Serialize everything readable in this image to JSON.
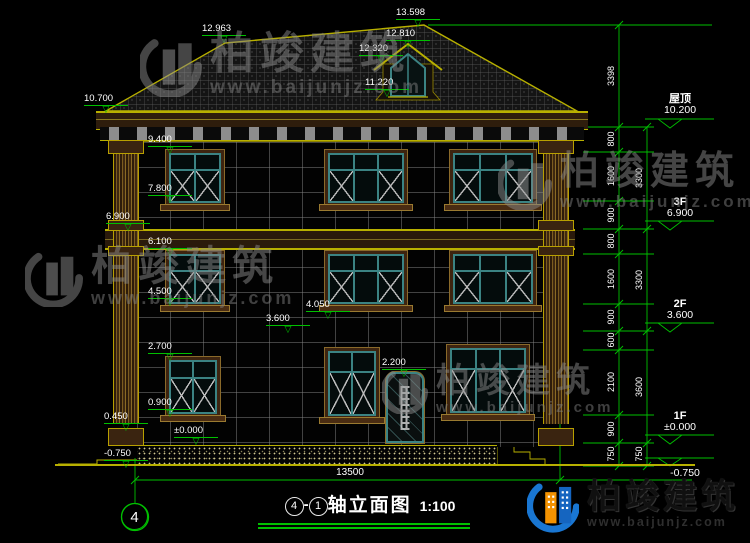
{
  "watermark": {
    "brand": "柏竣建筑",
    "url": "www.baijunjz.com"
  },
  "title_block": {
    "axis_from": "4",
    "separator": "-",
    "axis_to": "1",
    "name": "轴立面图",
    "scale": "1:100"
  },
  "axis_bubble": {
    "label": "4"
  },
  "levels": {
    "peak": "13.598",
    "left_ridge": "12.963",
    "dormer_ridge": "12.810",
    "dormer_eave": "12.320",
    "dormer_sill": "11.220",
    "main_eave": "10.700",
    "f3_window_top": "9.400",
    "f3_window_sill": "7.800",
    "f3_floor": "6.900",
    "f2_window_top": "6.100",
    "f2_window_sill": "4.500",
    "canopy_top": "4.050",
    "canopy_bottom": "3.600",
    "f1_left_window_top": "2.700",
    "door_top": "2.200",
    "f1_window_sill": "0.900",
    "ground_floor": "±0.000",
    "plinth_top": "0.450",
    "site_ground": "-0.750"
  },
  "right_markers": [
    {
      "label": "屋顶",
      "value": "10.200"
    },
    {
      "label": "3F",
      "value": "6.900"
    },
    {
      "label": "2F",
      "value": "3.600"
    },
    {
      "label": "1F",
      "value": "±0.000"
    },
    {
      "label": "",
      "value": "-0.750"
    }
  ],
  "dims": {
    "right_inner": [
      "3398",
      "800",
      "1600",
      "900",
      "800",
      "1600",
      "900",
      "600",
      "2100",
      "900",
      "750"
    ],
    "right_outer": [
      "3300",
      "3300",
      "3600",
      "750"
    ],
    "bottom_width": "13500"
  },
  "icons": {
    "level_marker": "▽"
  },
  "colors": {
    "background": "#000000",
    "dim_green": "#00c000",
    "line_yellow": "#b8b000",
    "trim_brown": "#6e4119",
    "frame_teal": "#3b8383",
    "logo_blue": "#1565c0",
    "logo_orange": "#f39200"
  }
}
